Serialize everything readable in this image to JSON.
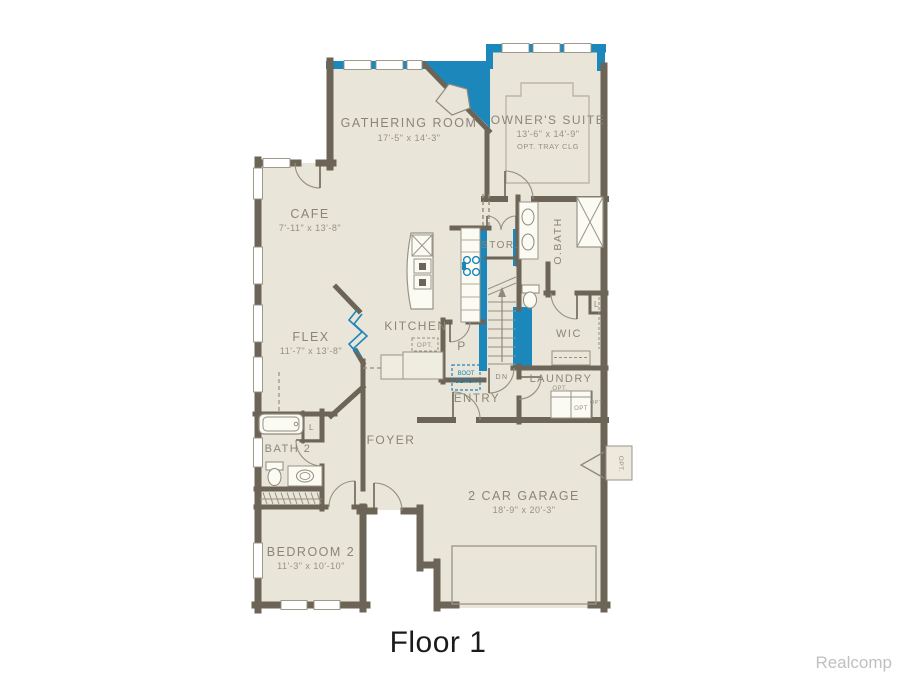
{
  "page": {
    "title": "Floor 1",
    "watermark": "Realcomp"
  },
  "colors": {
    "accent": "#1b87ba",
    "wall": "#6b6457",
    "floor": "#e9e5d8",
    "label": "#8b8577"
  },
  "rooms": {
    "gathering_room": {
      "name": "GATHERING ROOM",
      "dims": "17'-5\" x 14'-3\""
    },
    "owners_suite": {
      "name": "OWNER'S SUITE",
      "dims": "13'-6\" x 14'-9\"",
      "note": "OPT. TRAY CLG"
    },
    "cafe": {
      "name": "CAFE",
      "dims": "7'-11\" x 13'-8\""
    },
    "flex": {
      "name": "FLEX",
      "dims": "11'-7\" x 13'-8\""
    },
    "kitchen": {
      "name": "KITCHEN",
      "opt_label": "OPT."
    },
    "pantry": {
      "abbr": "P"
    },
    "storage": {
      "abbr": "STOR."
    },
    "owners_bath": {
      "abbr": "O.BATH"
    },
    "wic": {
      "abbr": "WIC",
      "linen": "L"
    },
    "laundry": {
      "name": "LAUNDRY",
      "opt_washer": "OPT.",
      "opt_dryer": "OPT",
      "opt_door": "OPT."
    },
    "entry": {
      "name": "ENTRY",
      "boot_bench_line1": "BOOT",
      "boot_bench_line2": "BENCH"
    },
    "foyer": {
      "name": "FOYER"
    },
    "bath2": {
      "name": "BATH 2",
      "linen": "L"
    },
    "bedroom2": {
      "name": "BEDROOM 2",
      "dims": "11'-3\" x 10'-10\""
    },
    "garage": {
      "name": "2 CAR GARAGE",
      "dims": "18'-9\" x 20'-3\"",
      "opt_door": "OPT."
    },
    "stairs": {
      "down": "DN"
    }
  }
}
